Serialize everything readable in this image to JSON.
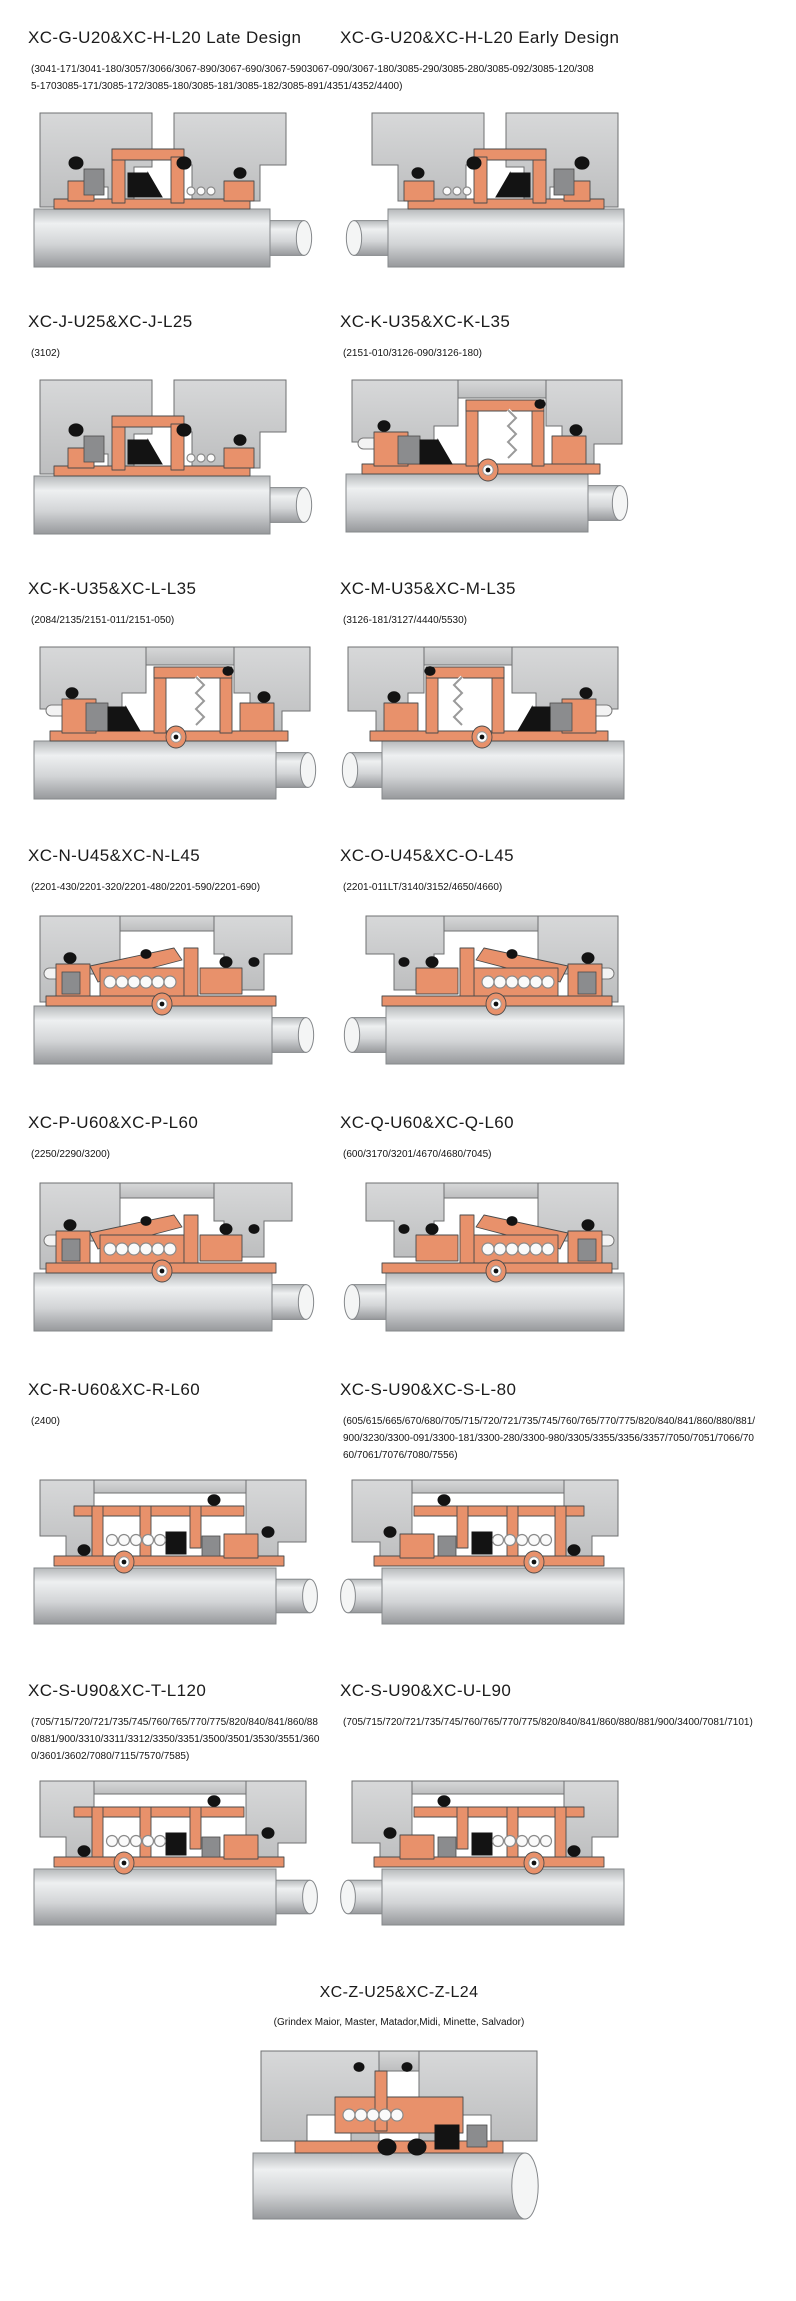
{
  "colors": {
    "component_salmon": "#e8916b",
    "housing_gray": "#c9cacb",
    "o_ring_black": "#131313",
    "shaft_gray": "#d3d5d7",
    "background": "#ffffff"
  },
  "sections": [
    {
      "kind": "shared-subtitle-pair",
      "subtitle": "(3041-171/3041-180/3057/3066/3067-890/3067-690/3067-5903067-090/3067-180/3085-290/3085-280/3085-092/3085-120/3085-1703085-171/3085-172/3085-180/3085-181/3085-182/3085-891/4351/4352/4400)",
      "cells": [
        {
          "title": "XC-G-U20&XC-H-L20 Late Design",
          "variant": "A"
        },
        {
          "title": "XC-G-U20&XC-H-L20 Early Design",
          "variant": "Am"
        }
      ]
    },
    {
      "kind": "pair",
      "cells": [
        {
          "title": "XC-J-U25&XC-J-L25",
          "subtitle": "(3102)",
          "variant": "A"
        },
        {
          "title": "XC-K-U35&XC-K-L35",
          "subtitle": "(2151-010/3126-090/3126-180)",
          "variant": "B"
        }
      ]
    },
    {
      "kind": "pair",
      "cells": [
        {
          "title": "XC-K-U35&XC-L-L35",
          "subtitle": "(2084/2135/2151-011/2151-050)",
          "variant": "B"
        },
        {
          "title": "XC-M-U35&XC-M-L35",
          "subtitle": "(3126-181/3127/4440/5530)",
          "variant": "Bm"
        }
      ]
    },
    {
      "kind": "pair",
      "cells": [
        {
          "title": "XC-N-U45&XC-N-L45",
          "subtitle": "(2201-430/2201-320/2201-480/2201-590/2201-690)",
          "variant": "C"
        },
        {
          "title": "XC-O-U45&XC-O-L45",
          "subtitle": "(2201-011LT/3140/3152/4650/4660)",
          "variant": "Cm"
        }
      ]
    },
    {
      "kind": "pair",
      "cells": [
        {
          "title": "XC-P-U60&XC-P-L60",
          "subtitle": "(2250/2290/3200)",
          "variant": "C"
        },
        {
          "title": "XC-Q-U60&XC-Q-L60",
          "subtitle": "(600/3170/3201/4670/4680/7045)",
          "variant": "Cm"
        }
      ]
    },
    {
      "kind": "pair",
      "cells": [
        {
          "title": "XC-R-U60&XC-R-L60",
          "subtitle": "(2400)",
          "variant": "D"
        },
        {
          "title": "XC-S-U90&XC-S-L-80",
          "subtitle": "(605/615/665/670/680/705/715/720/721/735/745/760/765/770/775/820/840/841/860/880/881/900/3230/3300-091/3300-181/3300-280/3300-980/3305/3355/3356/3357/7050/7051/7066/7060/7061/7076/7080/7556)",
          "variant": "Dm"
        }
      ]
    },
    {
      "kind": "pair",
      "cells": [
        {
          "title": "XC-S-U90&XC-T-L120",
          "subtitle": "(705/715/720/721/735/745/760/765/770/775/820/840/841/860/880/881/900/3310/3311/3312/3350/3351/3500/3501/3530/3551/3600/3601/3602/7080/7115/7570/7585)",
          "variant": "D"
        },
        {
          "title": "XC-S-U90&XC-U-L90",
          "subtitle": "(705/715/720/721/735/745/760/765/770/775/820/840/841/860/880/881/900/3400/7081/7101)",
          "variant": "Dm"
        }
      ]
    },
    {
      "kind": "single-centered",
      "cells": [
        {
          "title": "XC-Z-U25&XC-Z-L24",
          "subtitle": "(Grindex  Maior, Master, Matador,Midi, Minette, Salvador)",
          "variant": "Z"
        }
      ]
    }
  ]
}
